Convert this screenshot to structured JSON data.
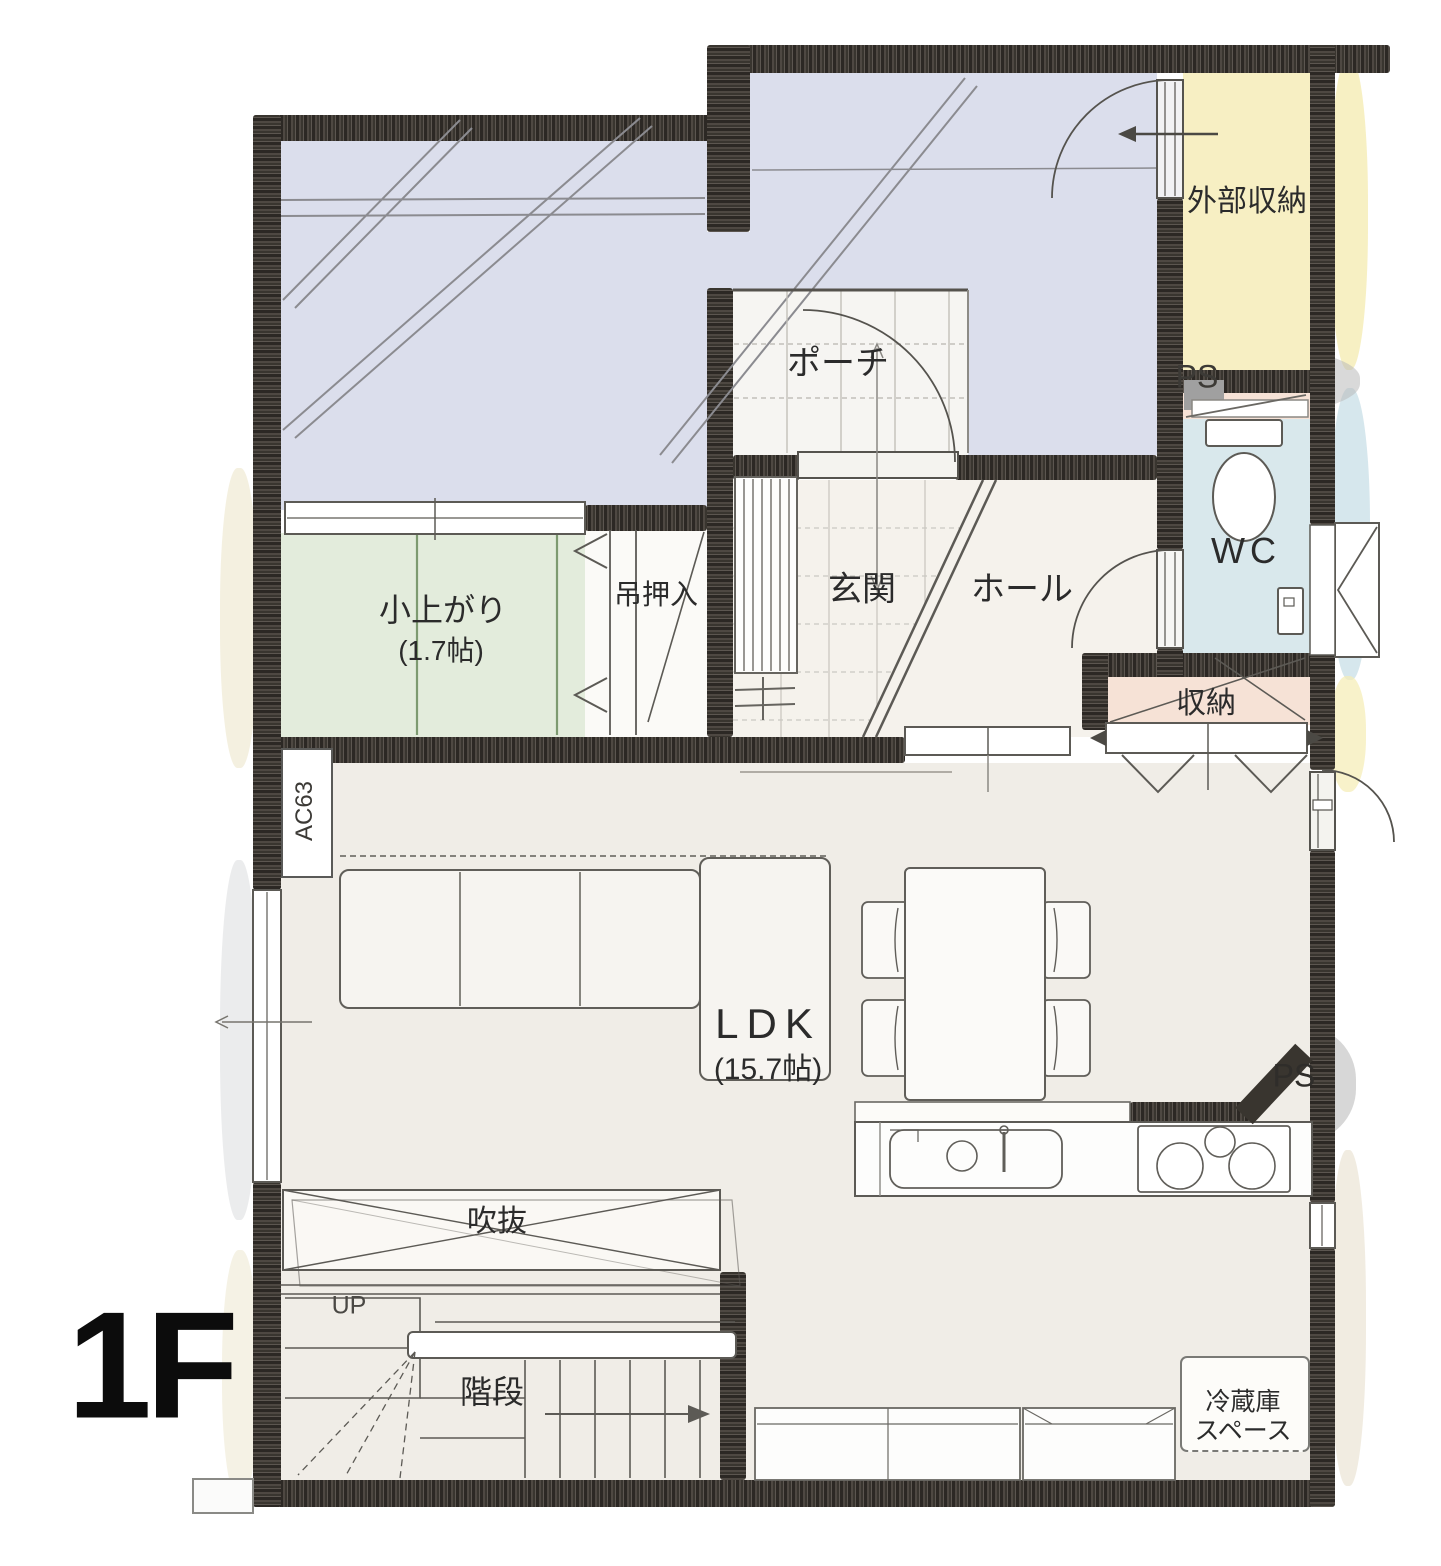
{
  "floor_label": "1F",
  "rooms": {
    "exterior_storage": {
      "name": "外部収納"
    },
    "porch": {
      "name": "ポーチ"
    },
    "pipe_space_upper": {
      "name": "PS"
    },
    "toilet": {
      "name": "WC"
    },
    "entrance": {
      "name": "玄関"
    },
    "hall": {
      "name": "ホール"
    },
    "tatami_corner": {
      "name": "小上がり",
      "size": "(1.7帖)"
    },
    "hanging_closet": {
      "name": "吊押入"
    },
    "closet": {
      "name": "収納"
    },
    "ldk": {
      "name": "LDK",
      "size": "(15.7帖)"
    },
    "pipe_space_lower": {
      "name": "PS"
    },
    "void": {
      "name": "吹抜"
    },
    "stairs": {
      "name": "階段",
      "direction_label": "UP"
    },
    "refrigerator_space": {
      "name_line1": "冷蔵庫",
      "name_line2": "スペース"
    },
    "air_conditioner": {
      "name": "AC63"
    }
  },
  "colors": {
    "wall": "#39352f",
    "carport_area": "#dbdeec",
    "tatami_area": "#e3ecdc",
    "exterior_storage": "#f7efc3",
    "wc_area": "#d9e8ec",
    "closet_area": "#f6e2d6",
    "ldk_floor": "#f0ede7",
    "pipe_space_gray": "#a0a0a0"
  }
}
